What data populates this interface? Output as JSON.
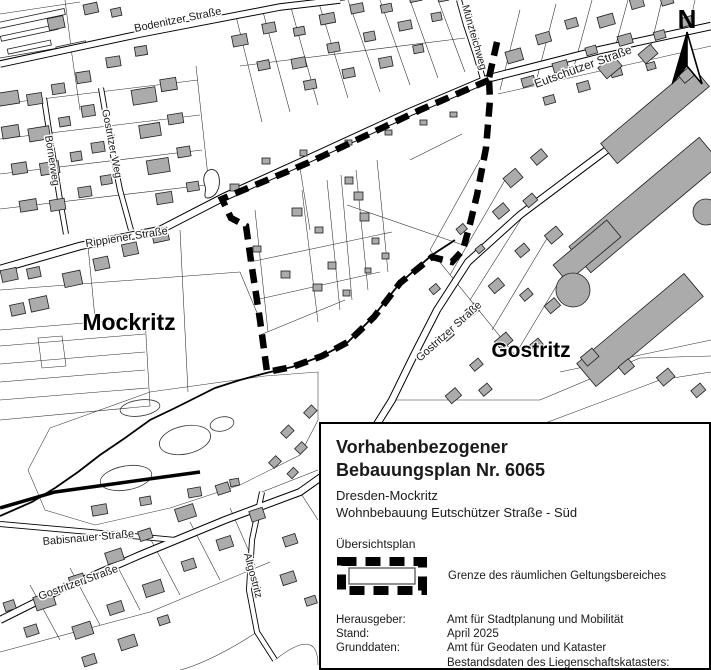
{
  "map": {
    "area_labels": [
      {
        "text": "Mockritz"
      },
      {
        "text": "Gostritz"
      }
    ],
    "street_labels": [
      {
        "name": "Bodenitzer Straße"
      },
      {
        "name": "Münzteichweg"
      },
      {
        "name": "Eutschützer Straße"
      },
      {
        "name": "Gostritzer Weg"
      },
      {
        "name": "Börnerweg"
      },
      {
        "name": "Rippiener Straße"
      },
      {
        "name": "Gostritzer Straße"
      },
      {
        "name": "Babisnauer Straße"
      },
      {
        "name": "Gostritzer Straße"
      },
      {
        "name": "Altgostritz"
      }
    ],
    "north_label": "N",
    "colors": {
      "building_fill": "#ababab",
      "line": "#000000",
      "boundary": "#000000"
    }
  },
  "info_box": {
    "title_line1": "Vorhabenbezogener",
    "title_line2": "Bebauungsplan Nr. 6065",
    "subtitle_line1": "Dresden-Mockritz",
    "subtitle_line2": "Wohnbebauung Eutschützer Straße - Süd",
    "plan_type": "Übersichtsplan",
    "legend_label": "Grenze des räumlichen Geltungsbereiches",
    "meta": {
      "publisher_label": "Herausgeber:",
      "publisher_value": "Amt für Stadtplanung und Mobilität",
      "date_label": "Stand:",
      "date_value": "April 2025",
      "basedata_label": "Grunddaten:",
      "basedata_value1": "Amt für Geodaten und Kataster",
      "basedata_value2": "Bestandsdaten des Liegenschaftskatasters:",
      "basedata_value3": "Landesamt für Geobasisinformation Sachsen"
    }
  }
}
